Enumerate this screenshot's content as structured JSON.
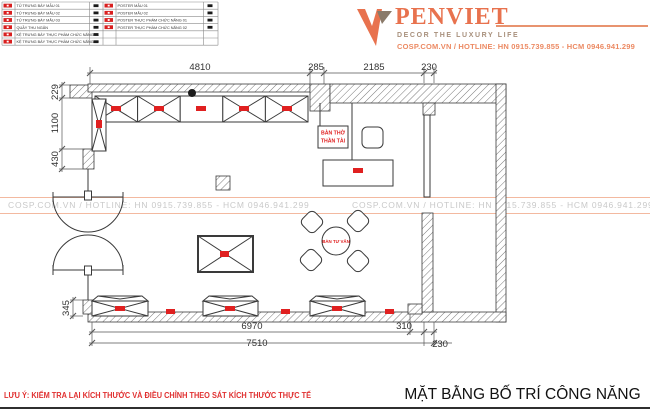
{
  "logo": {
    "brand": "PENVIET",
    "tagline": "DECOR THE LUXURY LIFE",
    "contact": "COSP.COM.VN / HOTLINE: HN 0915.739.855 - HCM 0946.941.299",
    "brand_color": "#e8724e",
    "tagline_color": "#a8907c"
  },
  "watermark": {
    "text": "COSP.COM.VN / HOTLINE: HN 0915.739.855 - HCM 0946.941.299",
    "text_color": "#c9c9c9",
    "line_color": "#f3b9a0"
  },
  "legend": {
    "marker_color": "#d81f1f",
    "left": [
      "TỦ TRƯNG BÀY MẪU 01",
      "TỦ TRƯNG BÀY MẪU 02",
      "TỦ TRƯNG BÀY MẪU 03",
      "QUẦY THU NGÂN",
      "KỆ TRƯNG BÀY THỰC PHẨM CHỨC NĂNG 01",
      "KỆ TRƯNG BÀY THỰC PHẨM CHỨC NĂNG 02"
    ],
    "right": [
      "POSTER MẪU 01",
      "POSTER MẪU 02",
      "POSTER THỰC PHẨM CHỨC NĂNG 01",
      "POSTER THỰC PHẨM CHỨC NĂNG 02",
      "",
      ""
    ]
  },
  "plan": {
    "dims": {
      "top": [
        "4810",
        "285",
        "2185",
        "230"
      ],
      "left": [
        "229",
        "1100",
        "430"
      ],
      "left_bottom": "345",
      "bottom": [
        "6970",
        "310"
      ],
      "bottom_total": "7510",
      "bottom_right": "230"
    },
    "labels": {
      "altar": [
        "BÀN THỜ",
        "THẦN TÀI"
      ],
      "consult_table": "BÀN TƯ VẤN"
    },
    "marker_color": "#e02020"
  },
  "footer": {
    "note": "LƯU Ý: KIỂM TRA LẠI KÍCH THƯỚC VÀ ĐIỀU CHỈNH THEO SÁT KÍCH THƯỚC THỰC TẾ",
    "title": "MẶT BẰNG BỐ TRÍ CÔNG NĂNG"
  }
}
